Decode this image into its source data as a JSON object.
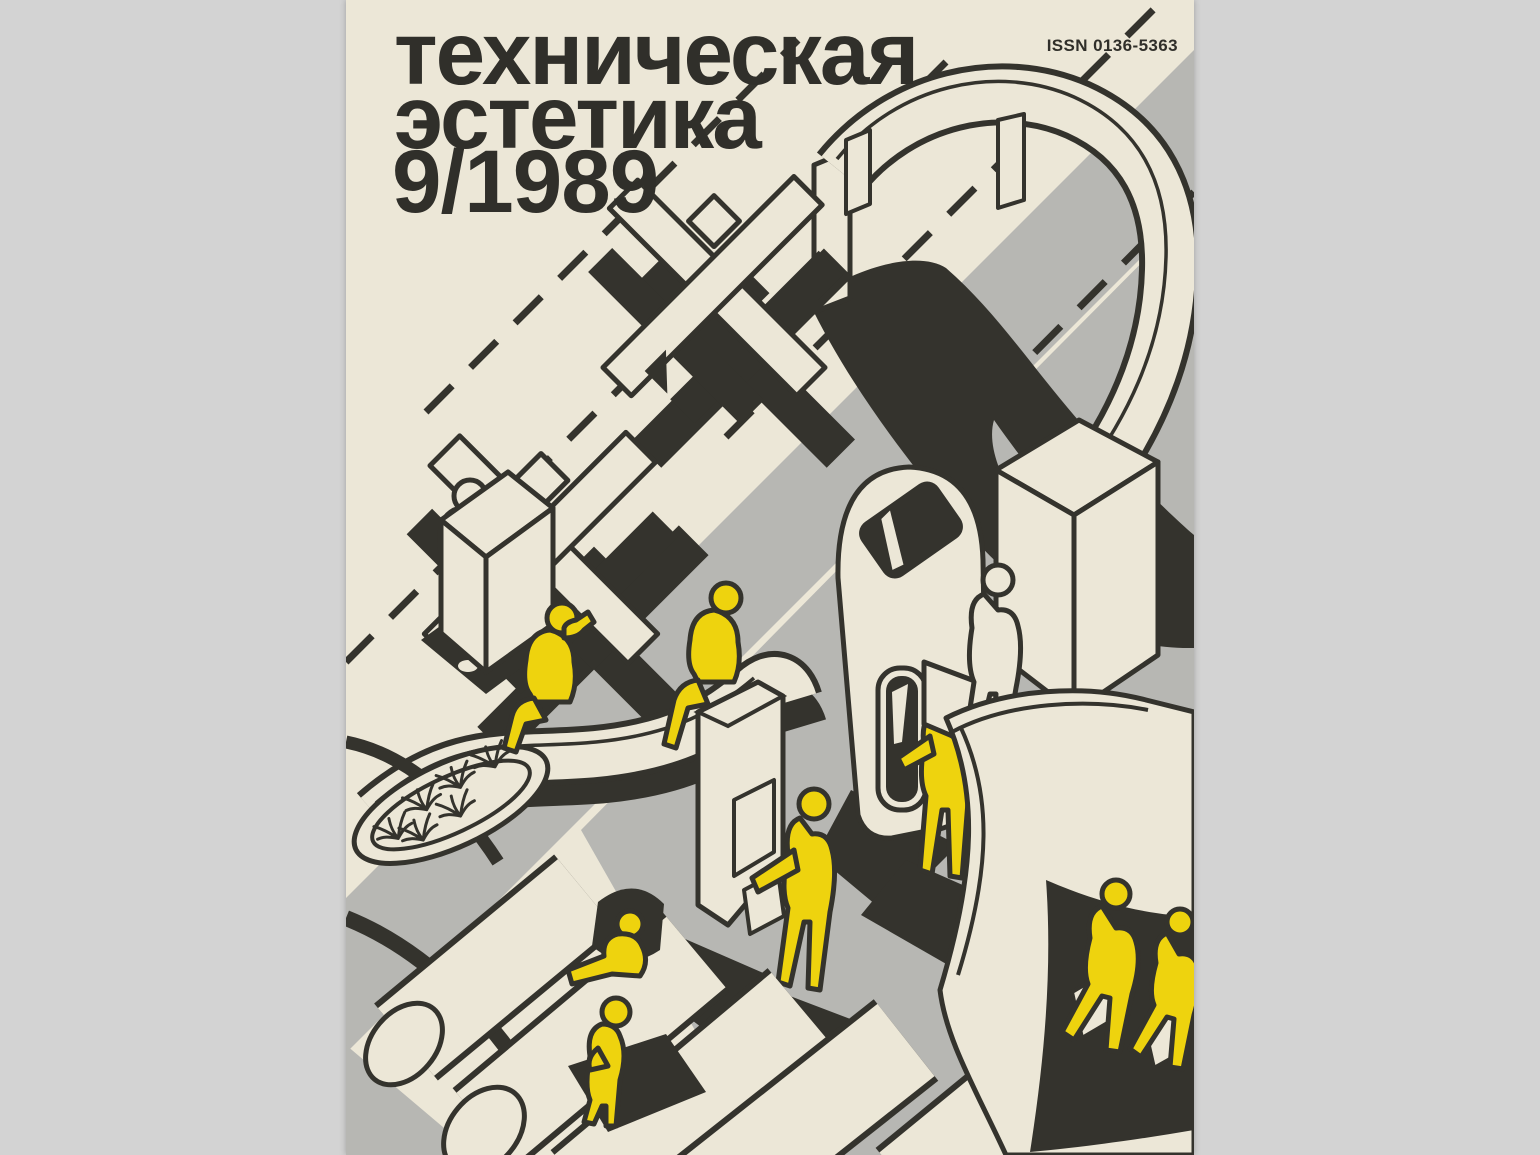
{
  "colors": {
    "page-bg": "#d3d3d3",
    "cream": "#ece7d7",
    "ink": "#34332d",
    "gray": "#b7b7b3",
    "yellow": "#eed30e",
    "title-ink": "#302f2a"
  },
  "masthead": {
    "title_line1": "техническая",
    "title_line2": "эстетика",
    "issue": "9/1989"
  },
  "issn": "ISSN 0136-5363",
  "illustration": {
    "description": "Isometric exhibition scene: S-curved elevated walkway, suprematist cross sculptures, rolling display cabinet with attendant, phone and info kiosks, serpentine bench with palm planter, cylindrical pavilions and a concave tower, populated by yellow silhouette visitors."
  }
}
